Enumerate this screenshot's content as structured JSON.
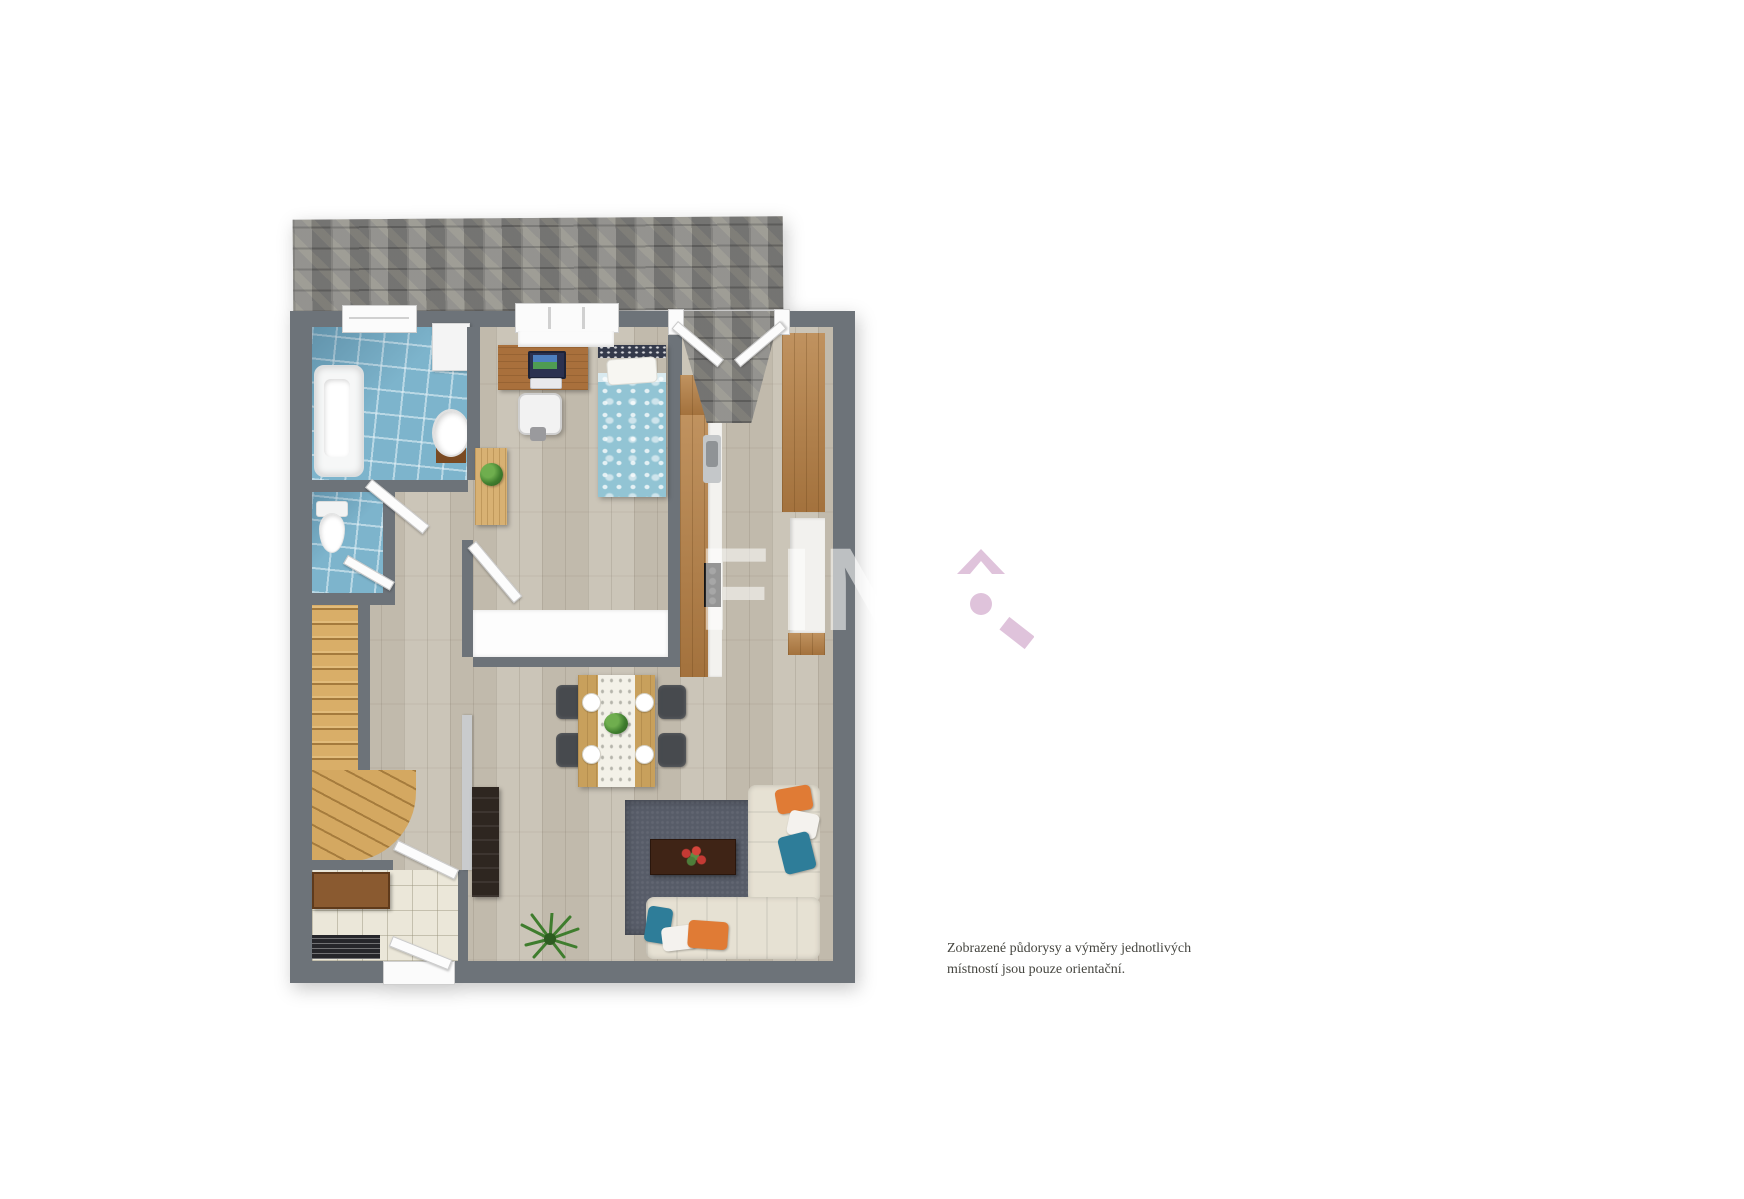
{
  "canvas": {
    "width": 1744,
    "height": 1199,
    "background": "#ffffff"
  },
  "watermark": {
    "text": "FIN"
  },
  "brand_logo": {
    "color": "#dcbdd8",
    "shapes": [
      "chevron-up",
      "dot",
      "diagonal-bar"
    ]
  },
  "disclaimer": {
    "line1": "Zobrazené půdorysy a výměry jednotlivých",
    "line2": "místností jsou pouze orientační."
  },
  "palette": {
    "wall_gray": "#6d7379",
    "roof_gray": "#8b8a84",
    "wood_floor": "#c7c0b2",
    "bathroom_tile": "#7db4cc",
    "entry_tile": "#ebe7d9",
    "stairs_wood": "#d9ae68",
    "cabinet_wood": "#b07c45",
    "desk_wood": "#a9703c",
    "dining_table_wood": "#c8a05c",
    "bed_duvet_blue": "#92c4d4",
    "sofa_cream": "#e6e1d3",
    "rug_dark": "#575c68",
    "coffee_table_brown": "#3f2416",
    "tv_cabinet_dark": "#2e2620",
    "pillow_orange": "#e07b35",
    "pillow_teal": "#2e7d99",
    "pillow_white": "#f4f2ee",
    "plant_green": "#3f7d2e",
    "radiator_black": "#26262a"
  }
}
